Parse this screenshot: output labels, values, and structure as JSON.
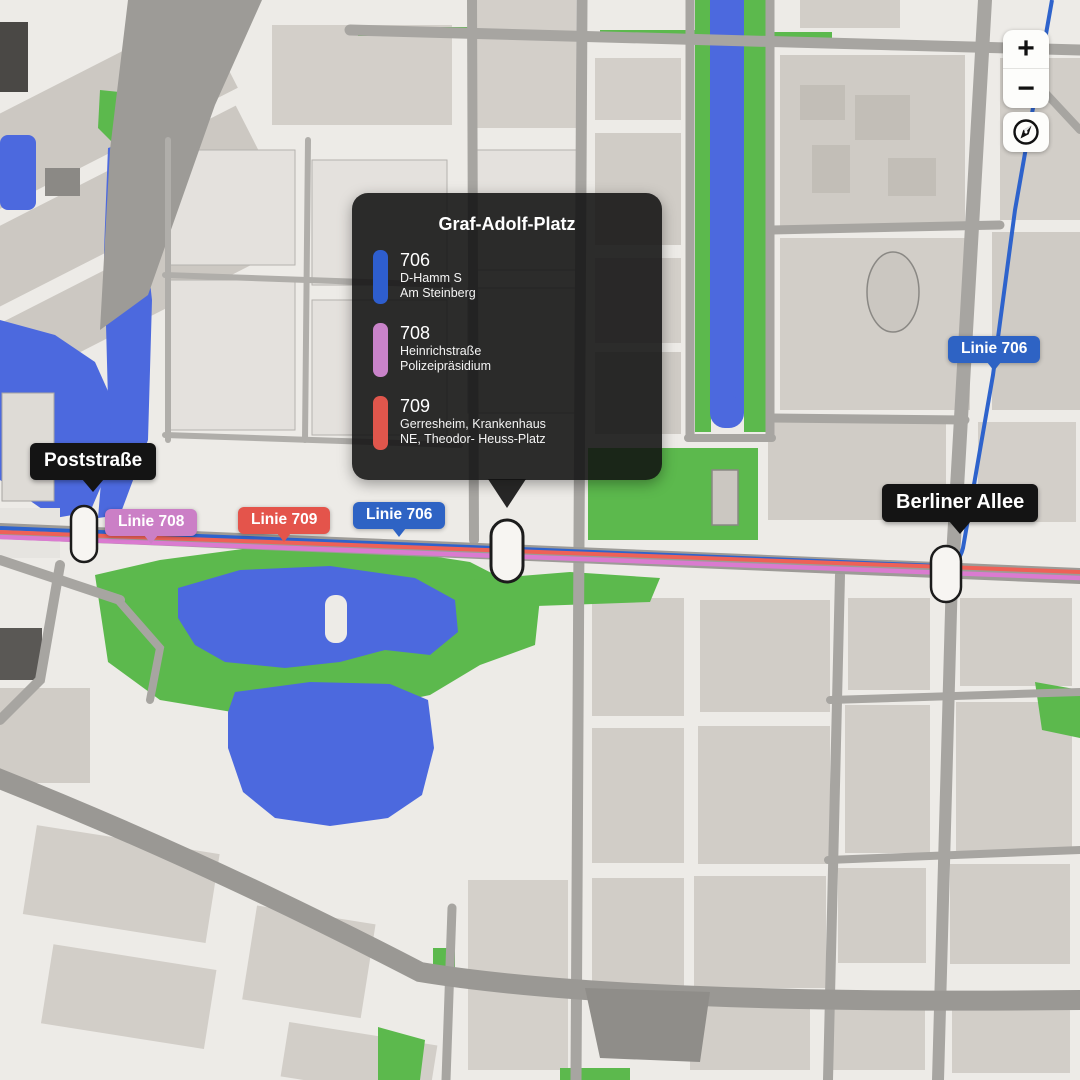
{
  "popup": {
    "title": "Graf-Adolf-Platz",
    "lines": [
      {
        "number": "706",
        "color": "#2e5ece",
        "destinations": [
          "D-Hamm S",
          "Am Steinberg"
        ]
      },
      {
        "number": "708",
        "color": "#c983c9",
        "destinations": [
          "Heinrichstraße",
          "Polizeipräsidium"
        ]
      },
      {
        "number": "709",
        "color": "#e0564c",
        "destinations": [
          "Gerresheim, Krankenhaus",
          "NE, Theodor- Heuss-Platz"
        ]
      }
    ]
  },
  "station_labels": [
    {
      "name": "Poststraße"
    },
    {
      "name": "Berliner Allee"
    }
  ],
  "line_badges": [
    {
      "label": "Linie 708",
      "color": "#cb7fc6"
    },
    {
      "label": "Linie 709",
      "color": "#e4544b"
    },
    {
      "label": "Linie 706",
      "color": "#2e63c4"
    },
    {
      "label": "Linie 706",
      "color": "#2e63c4"
    }
  ],
  "controls": {
    "zoom_in": "+",
    "zoom_out": "−",
    "compass": "compass-icon"
  },
  "map_colors": {
    "background": "#edebe7",
    "water": "#4c69de",
    "park": "#5cb94d",
    "line_706": "#2e63cc",
    "line_708": "#da7bd0",
    "line_709": "#ee6157"
  }
}
